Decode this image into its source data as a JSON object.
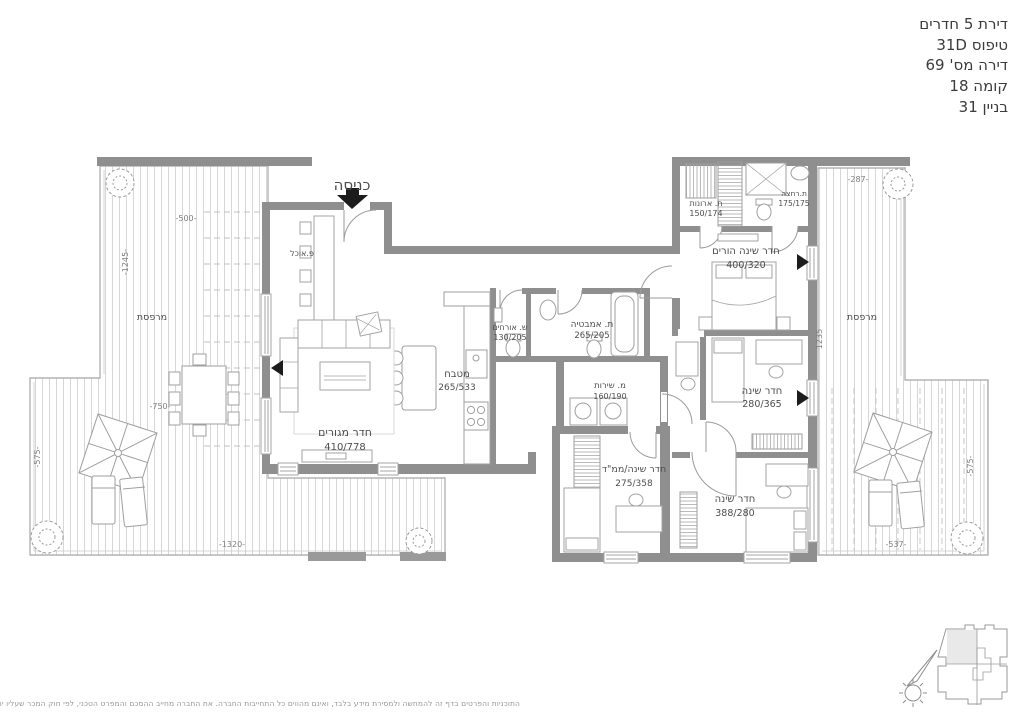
{
  "header": {
    "line1": "דירת 5 חדרים",
    "line2": "טיפוס 31D",
    "line3": "דירה מס' 69",
    "line4": "קומה 18",
    "line5": "בניין 31"
  },
  "plan": {
    "entrance_label": "כניסה",
    "rooms": {
      "living": {
        "name": "חדר מגורים",
        "size": "410/778"
      },
      "dining": {
        "name": "פ.אוכל"
      },
      "kitchen": {
        "name": "מטבח",
        "size": "265/533"
      },
      "guest_wc": {
        "name": "ש. אורחים",
        "size": "130/205"
      },
      "bathroom": {
        "name": "ת. אמבטיה",
        "size": "265/205"
      },
      "service": {
        "name": "מ. שירות",
        "size": "160/190"
      },
      "closet_room": {
        "name": "ת. ארונות",
        "size": "150/174"
      },
      "shower_room": {
        "name": "ת.רחצה",
        "size": "175/175"
      },
      "master": {
        "name": "חדר שינה הורים",
        "size": "400/320"
      },
      "bedroom2": {
        "name": "חדר שינה",
        "size": "280/365"
      },
      "mamad": {
        "name": "חדר שינה/ממ\"ד",
        "size": "275/358"
      },
      "bedroom3": {
        "name": "חדר שינה",
        "size": "388/280"
      },
      "terrace_left": {
        "name": "מרפסת"
      },
      "terrace_right": {
        "name": "מרפסת"
      }
    },
    "dims": {
      "d500": "-500-",
      "d1245": "-1245-",
      "d750": "-750-",
      "d575l": "-575-",
      "d1320": "-1320-",
      "d287": "-287-",
      "d1235": "1235",
      "d575r": "-575-",
      "d537": "-537-"
    }
  },
  "disclaimer": "התוכניות והפרטים בדף זה להמחשה ולמסירת מידע בלבד, ואינם מהווים כל התחייבות החברה. את החברה מחייב ההסכם והמפרט הטכני, לפי חוק המכר שעליו יחתמו החברה והרוכשים.",
  "colors": {
    "wall": "#8f8f8f",
    "label": "#4d4d4d",
    "dim": "#7e7e7e",
    "deck_line": "#d7d7d7"
  }
}
